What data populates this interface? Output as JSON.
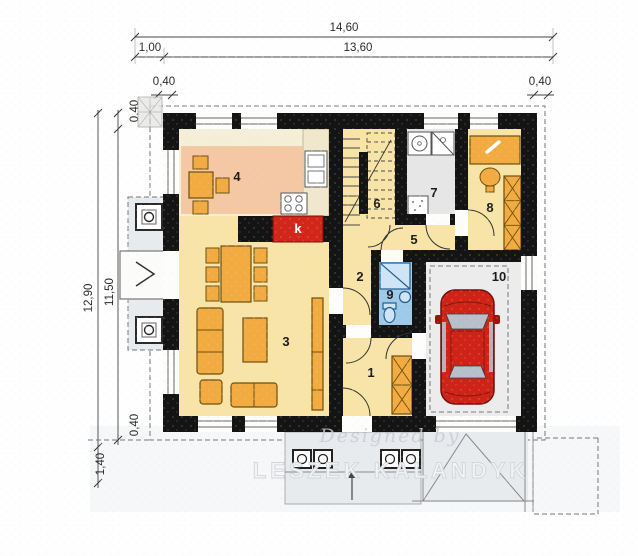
{
  "plan": {
    "dims": {
      "width_total": "14,60",
      "width_left": "1,00",
      "width_main": "13,60",
      "wall_thickness": "0,40",
      "height_total": "12,90",
      "height_inner": "11,50",
      "porch_depth": "1,40"
    },
    "rooms": {
      "r1": "1",
      "r2": "2",
      "r3": "3",
      "r4": "4",
      "r5": "5",
      "r6": "6",
      "r7": "7",
      "r8": "8",
      "r9": "9",
      "r10": "10"
    },
    "fireplace": "k",
    "watermark": {
      "script": "Designed by",
      "name": "LESZEK KALANDYK"
    }
  },
  "colors": {
    "floor_yellow": "#f7e4a6",
    "floor_cream": "#f6efd8",
    "counter_cream": "#f0e7cc",
    "floor_peach": "#f5c8a3",
    "floor_gray": "#e6e6e6",
    "floor_blue": "#9ec9e8",
    "garage_gray": "#ececec",
    "outdoor_gray": "#e7ebee",
    "furniture_orange": "#f2ab41",
    "fireplace_red": "#d3261a",
    "car_red": "#cf2318",
    "wall_black": "#141414"
  }
}
